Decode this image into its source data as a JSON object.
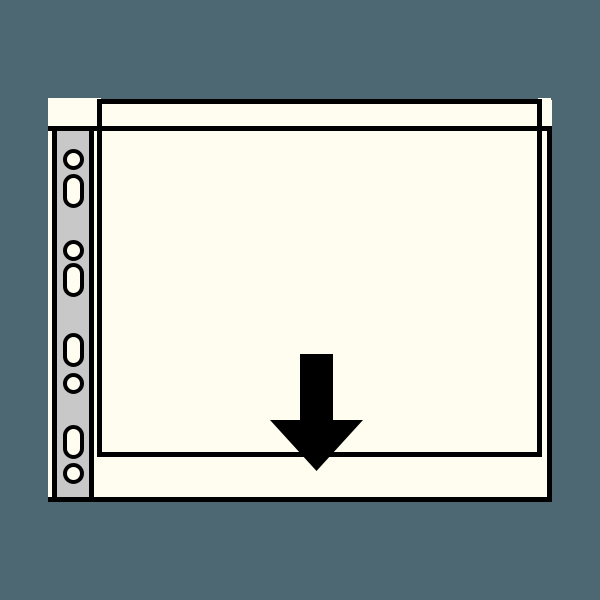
{
  "diagram": {
    "subject": "punched-pocket-sheet-protector",
    "colors": {
      "background": "#4d6872",
      "sheet": "#fffdf0",
      "strip": "#c8c8c8",
      "line": "#000000"
    },
    "sheet": {
      "base": {
        "x": 48,
        "y": 100,
        "w": 504,
        "h": 402
      },
      "top_left_tab": {
        "x": 48,
        "y": 98,
        "w": 53,
        "h": 31
      },
      "top_right_tab": {
        "x": 538,
        "y": 98,
        "w": 13,
        "h": 31
      },
      "bottom_edge": {
        "x": 48,
        "y": 497,
        "w": 504,
        "h": 5
      },
      "right_edge": {
        "x": 547,
        "y": 126,
        "w": 5,
        "h": 376
      },
      "seam_line": {
        "x": 48,
        "y": 126,
        "w": 504,
        "h": 5
      }
    },
    "pocket": {
      "x": 97,
      "y": 99,
      "w": 445,
      "h": 358
    },
    "filing_strip": {
      "x": 52,
      "y": 129,
      "w": 42,
      "h": 368
    },
    "holes": {
      "center_x": 73.5,
      "round_diameter": 21,
      "oblong_width": 21,
      "oblong_height": 34,
      "items": [
        {
          "type": "round",
          "cy": 159
        },
        {
          "type": "oblong",
          "cy": 191
        },
        {
          "type": "round",
          "cy": 250
        },
        {
          "type": "oblong",
          "cy": 280
        },
        {
          "type": "oblong",
          "cy": 350
        },
        {
          "type": "round",
          "cy": 383
        },
        {
          "type": "oblong",
          "cy": 442
        },
        {
          "type": "round",
          "cy": 473
        }
      ]
    },
    "arrow": {
      "direction": "down",
      "shaft": {
        "x": 300,
        "y": 354,
        "w": 33,
        "h": 66
      },
      "head": {
        "x": 270,
        "y": 420,
        "w": 93,
        "h": 51
      }
    }
  }
}
